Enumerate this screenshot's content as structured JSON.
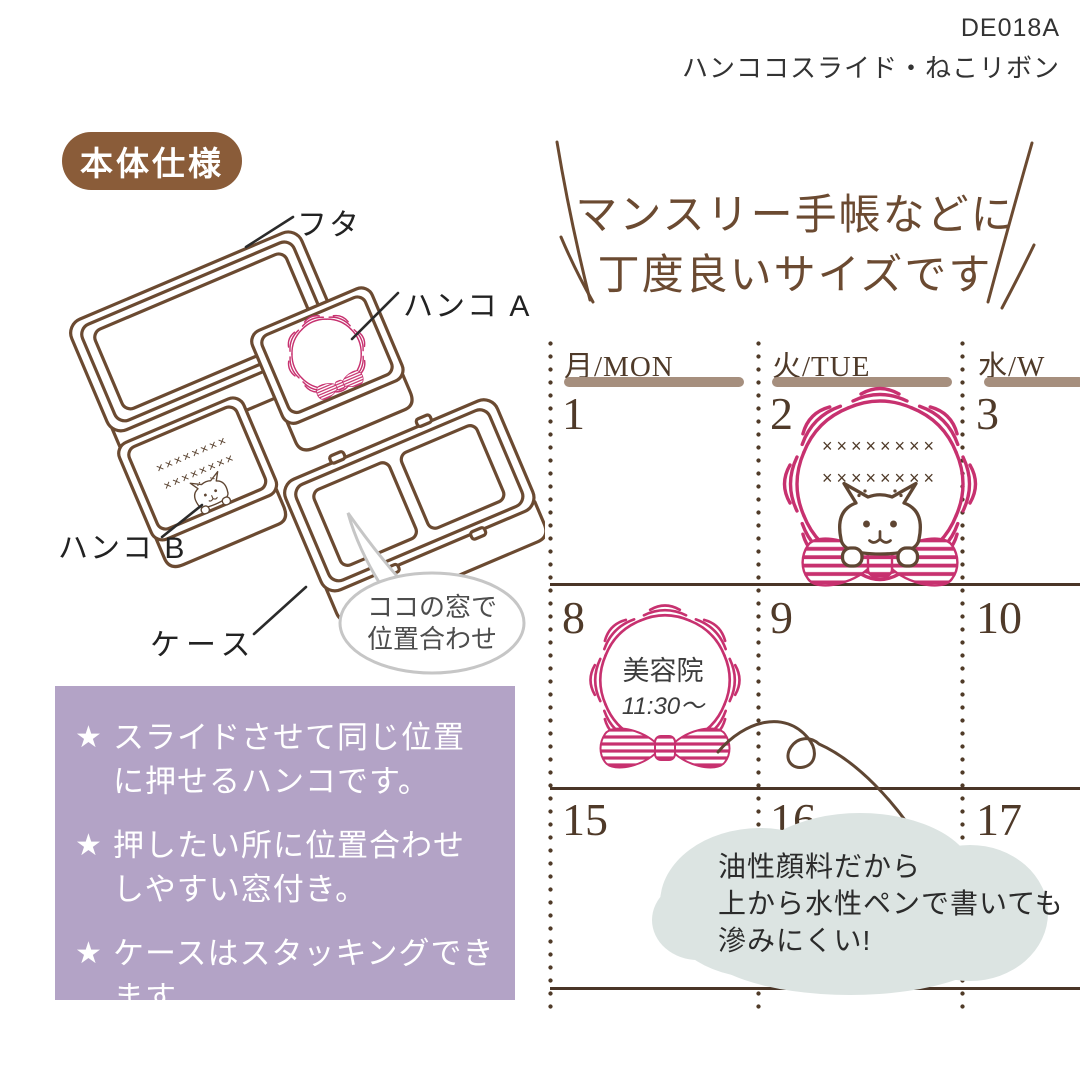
{
  "product": {
    "code": "DE018A",
    "name": "ハンココスライド・ねこリボン"
  },
  "spec": {
    "badge": "本体仕様",
    "labels": {
      "lid": "フタ",
      "stamp_a": "ハンコ A",
      "stamp_b": "ハンコ B",
      "case": "ケース"
    },
    "bubble": {
      "line1": "ココの窓で",
      "line2": "位置合わせ"
    },
    "stitch_row": "××××××××"
  },
  "features": {
    "star": "★",
    "items": [
      {
        "line1": "スライドさせて同じ位置",
        "line2": "に押せるハンコです。"
      },
      {
        "line1": "押したい所に位置合わせ",
        "line2": "しやすい窓付き。"
      },
      {
        "line1": "ケースはスタッキングできます。"
      }
    ]
  },
  "size_note": {
    "line1": "マンスリー手帳などに",
    "line2": "丁度良いサイズです"
  },
  "calendar": {
    "columns": [
      {
        "header": "月/MON",
        "dates": [
          "1",
          "8",
          "15"
        ]
      },
      {
        "header": "火/TUE",
        "dates": [
          "2",
          "9",
          "16"
        ]
      },
      {
        "header": "水/W",
        "dates": [
          "3",
          "10",
          "17"
        ]
      }
    ],
    "day2_stamp": {
      "stitch_row1": "××××××××",
      "stitch_row2": "××××××××"
    },
    "day8_stamp": {
      "line1": "美容院",
      "line2": "11:30〜"
    }
  },
  "ink_note": {
    "line1": "油性顔料だから",
    "line2": "上から水性ペンで書いても",
    "line3": "滲みにくい!"
  },
  "colors": {
    "pink": "#c7316f",
    "line_brown": "#6b4a31",
    "purple": "#b3a3c6",
    "badge_brown": "#8a5c39",
    "calendar_bar": "#a68f7e",
    "calendar_ink": "#4f3a29",
    "cloud": "#dce4e2"
  }
}
